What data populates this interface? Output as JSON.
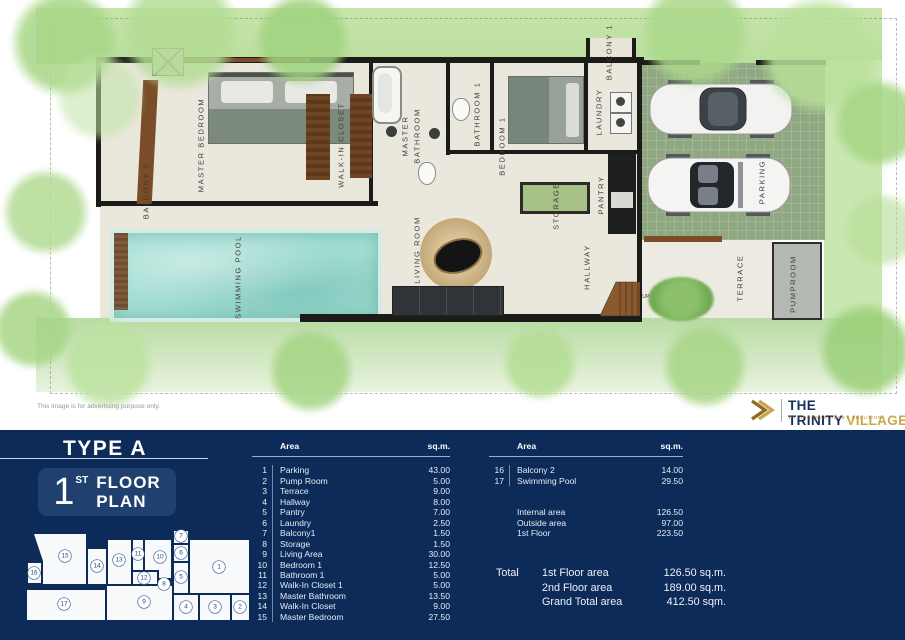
{
  "title": {
    "type": "TYPE A",
    "floor_num": "1",
    "floor_ord": "ST",
    "floor_line1": "FLOOR",
    "floor_line2": "PLAN"
  },
  "disclaimer": "This image is for advertising purpose only.",
  "brand": {
    "name": "THE TRINITY",
    "name_accent": "VILLAGE",
    "tagline": "BY ANDAMAN ASSET SOLUTION"
  },
  "plan_labels": [
    {
      "id": "balcony-2",
      "text": "BALCONY 2"
    },
    {
      "id": "master-bedroom",
      "text": "MASTER BEDROOM"
    },
    {
      "id": "walk-in-closet",
      "text": "WALK-IN  CLOSET"
    },
    {
      "id": "master-bathroom-1",
      "text": "MASTER"
    },
    {
      "id": "master-bathroom-2",
      "text": "BATHROOM"
    },
    {
      "id": "bathroom-1",
      "text": "BATHROOM 1"
    },
    {
      "id": "bedroom-1",
      "text": "BEDROOM 1"
    },
    {
      "id": "laundry",
      "text": "LAUNDRY"
    },
    {
      "id": "balcony-1",
      "text": "BALCONY 1"
    },
    {
      "id": "pantry",
      "text": "PANTRY"
    },
    {
      "id": "storage",
      "text": "STORAGE"
    },
    {
      "id": "hallway",
      "text": "HALLWAY"
    },
    {
      "id": "living-room",
      "text": "LIVING ROOM"
    },
    {
      "id": "swimming-pool",
      "text": "SWIMMING POOL"
    },
    {
      "id": "parking",
      "text": "PARKING"
    },
    {
      "id": "terrace",
      "text": "TERRACE"
    },
    {
      "id": "pumproom",
      "text": "PUMPROOM"
    },
    {
      "id": "up",
      "text": "UP"
    }
  ],
  "key_plan_numbers": [
    "1",
    "2",
    "3",
    "4",
    "5",
    "6",
    "7",
    "8",
    "9",
    "10",
    "11",
    "12",
    "13",
    "14",
    "15",
    "16",
    "17"
  ],
  "tables": {
    "left": {
      "headers": [
        "Area",
        "sq.m."
      ],
      "rows": [
        {
          "no": "1",
          "name": "Parking",
          "sqm": "43.00"
        },
        {
          "no": "2",
          "name": "Pump Room",
          "sqm": "5.00"
        },
        {
          "no": "3",
          "name": "Terrace",
          "sqm": "9.00"
        },
        {
          "no": "4",
          "name": "Hallway",
          "sqm": "8.00"
        },
        {
          "no": "5",
          "name": "Pantry",
          "sqm": "7.00"
        },
        {
          "no": "6",
          "name": "Laundry",
          "sqm": "2.50"
        },
        {
          "no": "7",
          "name": "Balcony1",
          "sqm": "1.50"
        },
        {
          "no": "8",
          "name": "Storage",
          "sqm": "1.50"
        },
        {
          "no": "9",
          "name": "Living Area",
          "sqm": "30.00"
        },
        {
          "no": "10",
          "name": "Bedroom 1",
          "sqm": "12.50"
        },
        {
          "no": "11",
          "name": "Bathroom 1",
          "sqm": "5.00"
        },
        {
          "no": "12",
          "name": "Walk-In Closet 1",
          "sqm": "5.00"
        },
        {
          "no": "13",
          "name": "Master Bathroom",
          "sqm": "13.50"
        },
        {
          "no": "14",
          "name": "Walk-In Closet",
          "sqm": "9.00"
        },
        {
          "no": "15",
          "name": "Master Bedroom",
          "sqm": "27.50"
        }
      ]
    },
    "right": {
      "headers": [
        "Area",
        "sq.m."
      ],
      "rows": [
        {
          "no": "16",
          "name": "Balcony 2",
          "sqm": "14.00"
        },
        {
          "no": "17",
          "name": "Swimming Pool",
          "sqm": "29.50"
        }
      ],
      "summary": [
        {
          "name": "Internal area",
          "sqm": "126.50"
        },
        {
          "name": "Outside area",
          "sqm": "97.00"
        },
        {
          "name": "1st Floor",
          "sqm": "223.50"
        }
      ]
    },
    "total": {
      "label": "Total",
      "rows": [
        {
          "name": "1st Floor area",
          "value": "126.50 sq.m."
        },
        {
          "name": "2nd Floor area",
          "value": "189.00 sq.m."
        },
        {
          "name": "Grand Total area",
          "value": "412.50 sqm."
        }
      ]
    }
  },
  "colors": {
    "panel_navy": "#0d2b58",
    "panel_box": "#20406f",
    "brand_gold": "#b28a33",
    "pool": "#a2ddd2",
    "lawn": "#c3e3a9",
    "storage_green": "#a6c086"
  }
}
